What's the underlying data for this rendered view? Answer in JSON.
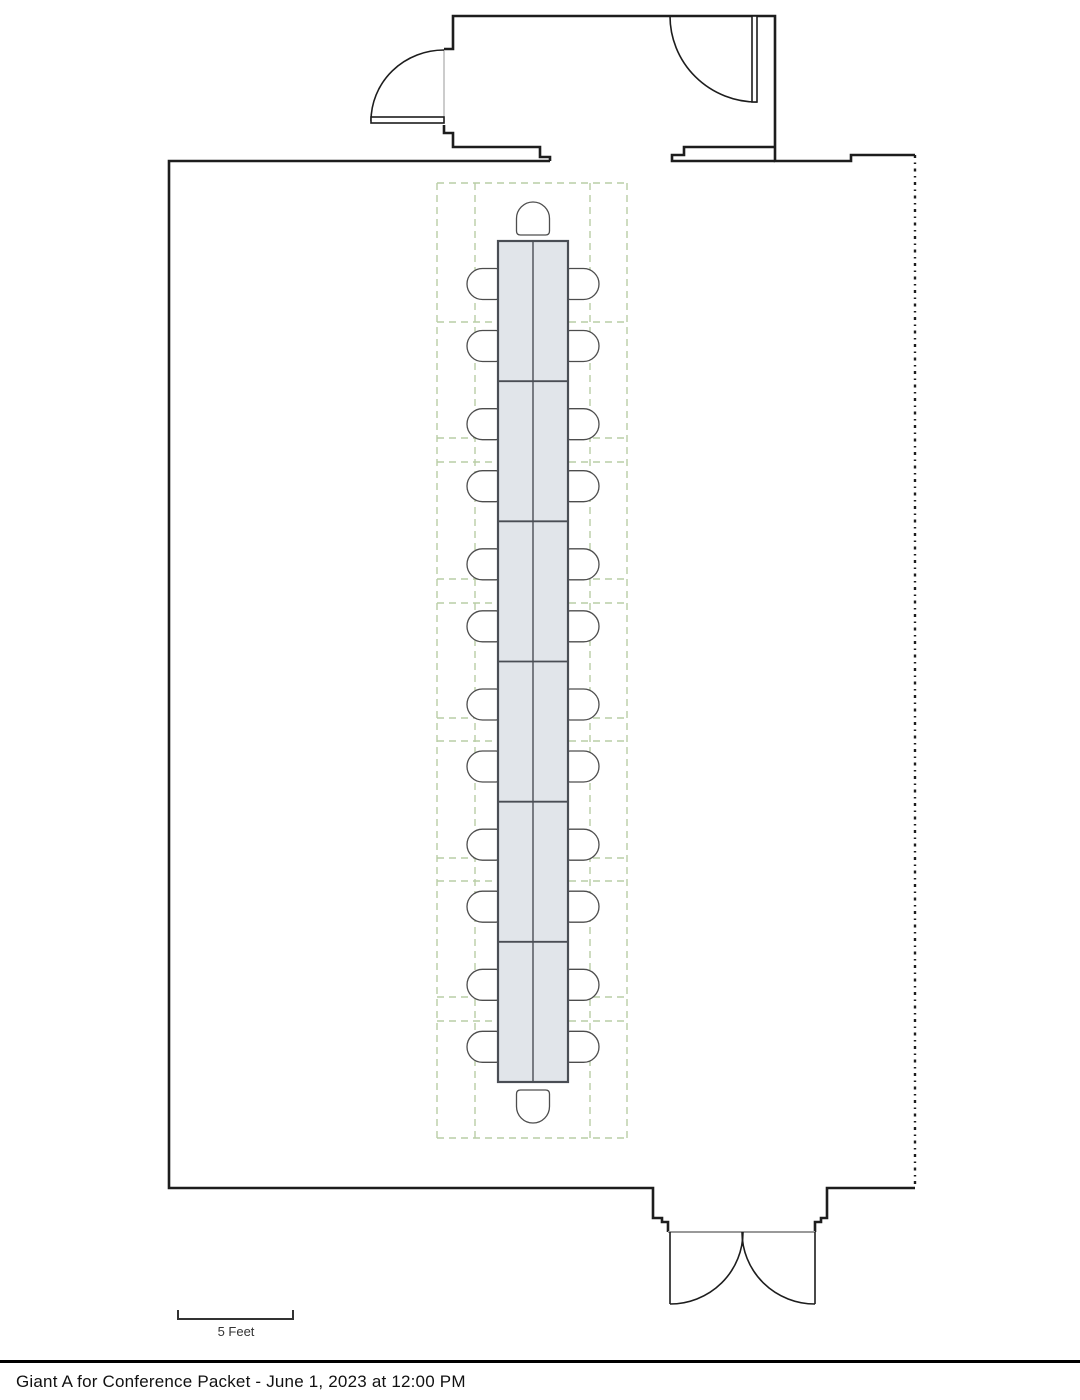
{
  "caption": {
    "text": "Giant A for Conference Packet - June 1, 2023 at 12:00 PM"
  },
  "scale_bar": {
    "label": "5 Feet"
  },
  "colors": {
    "wall": "#1d1d1d",
    "grid_dash": "#b9cda6",
    "table_fill": "#e1e5ea",
    "table_stroke": "#4a4e55",
    "chair_stroke": "#4d4d4d",
    "chair_fill": "#ffffff",
    "door_line": "#1d1d1d",
    "door_frame": "#aaaaaa",
    "threshold": "#999999"
  },
  "furniture": {
    "table_segments": 6,
    "chairs_per_side": 12,
    "head_chairs": 1,
    "foot_chairs": 1,
    "total_chairs": 26
  }
}
